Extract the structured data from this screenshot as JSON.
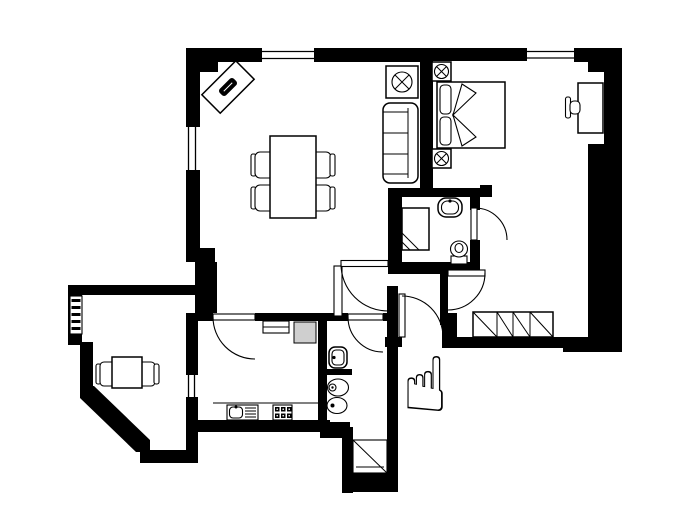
{
  "title": "apartment-floor-plan",
  "colors": {
    "wall": "#000000",
    "background": "#ffffff",
    "fixture": "#ffffff",
    "appliance": "#cfcfcf"
  },
  "cursor": {
    "name": "pointing-hand",
    "glyph": "☝"
  },
  "rooms": [
    {
      "name": "living-dining-room",
      "items": [
        "corner-desk",
        "dining-table",
        "dining-chairs-x4",
        "sofa",
        "side-table-with-plant"
      ]
    },
    {
      "name": "bedroom",
      "items": [
        "double-bed",
        "pillows-x2",
        "nightstand-with-lamp-x2",
        "desk",
        "desk-chair",
        "built-in-wardrobe"
      ]
    },
    {
      "name": "bathroom",
      "items": [
        "shower-tray",
        "washbasin",
        "toilet"
      ]
    },
    {
      "name": "wc",
      "items": [
        "washbasin",
        "toilet",
        "bidet"
      ]
    },
    {
      "name": "kitchen",
      "items": [
        "sink-with-drainer",
        "stove",
        "cooker-hood",
        "appliance-gray"
      ]
    },
    {
      "name": "office-balcony",
      "items": [
        "table",
        "chairs-x2",
        "radiator"
      ]
    },
    {
      "name": "hallway",
      "items": []
    },
    {
      "name": "storage-shaft",
      "items": [
        "diagonal-void"
      ]
    }
  ],
  "doors": [
    "entrance-door",
    "living-room-door",
    "kitchen-door",
    "bathroom-door",
    "bedroom-door",
    "wc-door",
    "balcony-opening"
  ],
  "windows": [
    "living-room-top-window",
    "living-room-left-window",
    "bedroom-top-window"
  ]
}
